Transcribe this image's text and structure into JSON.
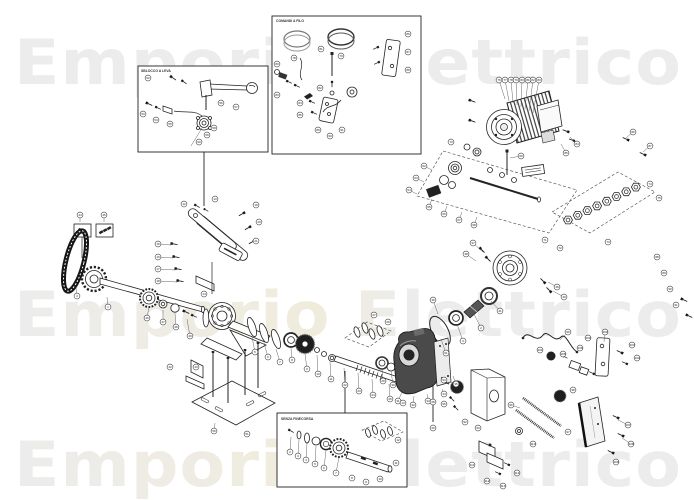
{
  "watermark": {
    "text": "Emporio Elettrico",
    "color": "#ececec",
    "tint": "#f2eeda"
  },
  "insets": {
    "release": {
      "label": "SBLOCCO A LEVA"
    },
    "controls": {
      "label": "COMANDI A FILO"
    },
    "no_limit": {
      "label": "SENZA FINECORSA"
    }
  },
  "diagram": {
    "balloons": [
      [
        52,
        148,
        78
      ],
      [
        53,
        143,
        114
      ],
      [
        54,
        156,
        120
      ],
      [
        55,
        170,
        124
      ],
      [
        56,
        221,
        103
      ],
      [
        57,
        236,
        107
      ],
      [
        58,
        214,
        128
      ],
      [
        59,
        207,
        135
      ],
      [
        60,
        199,
        142
      ],
      [
        78,
        294,
        58
      ],
      [
        79,
        341,
        56
      ],
      [
        80,
        277,
        64
      ],
      [
        81,
        321,
        49
      ],
      [
        82,
        320,
        88
      ],
      [
        83,
        277,
        95
      ],
      [
        84,
        300,
        103
      ],
      [
        85,
        300,
        115
      ],
      [
        86,
        408,
        34
      ],
      [
        87,
        408,
        52
      ],
      [
        88,
        408,
        70
      ],
      [
        89,
        318,
        130
      ],
      [
        90,
        330,
        136
      ],
      [
        91,
        342,
        130
      ],
      [
        15,
        158,
        244,
        171,
        245
      ],
      [
        16,
        158,
        257,
        173,
        258
      ],
      [
        17,
        158,
        269,
        175,
        270
      ],
      [
        18,
        158,
        281,
        177,
        282
      ],
      [
        12,
        184,
        204
      ],
      [
        13,
        215,
        199
      ],
      [
        19,
        256,
        205
      ],
      [
        20,
        259,
        222
      ],
      [
        21,
        256,
        241
      ],
      [
        14,
        204,
        294
      ],
      [
        44,
        80,
        215,
        80,
        222
      ],
      [
        45,
        104,
        215,
        104,
        222
      ],
      [
        4,
        77,
        296,
        76,
        288
      ],
      [
        1,
        108,
        307,
        107,
        297
      ],
      [
        46,
        147,
        318,
        149,
        307
      ],
      [
        47,
        163,
        322,
        163,
        310
      ],
      [
        48,
        176,
        327,
        175,
        313
      ],
      [
        49,
        190,
        336,
        187,
        319
      ],
      [
        42,
        170,
        367
      ],
      [
        43,
        196,
        367
      ],
      [
        50,
        214,
        431,
        215,
        423
      ],
      [
        51,
        247,
        434
      ],
      [
        5,
        255,
        352,
        252,
        337
      ],
      [
        6,
        268,
        357,
        264,
        343
      ],
      [
        7,
        280,
        362,
        276,
        349
      ],
      [
        8,
        292,
        360,
        291,
        348
      ],
      [
        9,
        307,
        369,
        305,
        354
      ],
      [
        10,
        318,
        374,
        317,
        355
      ],
      [
        11,
        331,
        379,
        330,
        362
      ],
      [
        22,
        345,
        385,
        344,
        368
      ],
      [
        23,
        359,
        391,
        358,
        373
      ],
      [
        24,
        373,
        395,
        372,
        379
      ],
      [
        25,
        390,
        399,
        389,
        384
      ],
      [
        26,
        433,
        428
      ],
      [
        27,
        374,
        315
      ],
      [
        28,
        388,
        322
      ],
      [
        29,
        383,
        381,
        382,
        369
      ],
      [
        30,
        393,
        385,
        391,
        371
      ],
      [
        31,
        398,
        401,
        402,
        392
      ],
      [
        32,
        413,
        405,
        414,
        396
      ],
      [
        33,
        428,
        401,
        427,
        394
      ],
      [
        34,
        444,
        394,
        442,
        389
      ],
      [
        35,
        456,
        384,
        453,
        376
      ],
      [
        36,
        433,
        300,
        438,
        314
      ],
      [
        37,
        473,
        243,
        483,
        252
      ],
      [
        38,
        466,
        254,
        476,
        261
      ],
      [
        39,
        557,
        287,
        548,
        282
      ],
      [
        40,
        564,
        297,
        553,
        291
      ],
      [
        41,
        500,
        311,
        491,
        301
      ],
      [
        2,
        481,
        328,
        473,
        312
      ],
      [
        3,
        463,
        341,
        457,
        324
      ],
      [
        61,
        446,
        353,
        441,
        339
      ],
      [
        62,
        424,
        166,
        432,
        170
      ],
      [
        63,
        416,
        178,
        424,
        182
      ],
      [
        64,
        409,
        190,
        417,
        194
      ],
      [
        65,
        429,
        207,
        432,
        199
      ],
      [
        66,
        444,
        214,
        447,
        206
      ],
      [
        67,
        459,
        220,
        462,
        212
      ],
      [
        68,
        474,
        225,
        477,
        217
      ],
      [
        69,
        521,
        156,
        510,
        158
      ],
      [
        70,
        451,
        142
      ],
      [
        71,
        545,
        240
      ],
      [
        72,
        560,
        248
      ],
      [
        73,
        608,
        242
      ],
      [
        74,
        650,
        184
      ],
      [
        75,
        659,
        198
      ],
      [
        76,
        499,
        80,
        505,
        99
      ],
      [
        77,
        505,
        80,
        509,
        101
      ],
      [
        78,
        511,
        80,
        513,
        103
      ],
      [
        79,
        516,
        80,
        517,
        105
      ],
      [
        80,
        522,
        80,
        521,
        107
      ],
      [
        81,
        528,
        80,
        525,
        109
      ],
      [
        82,
        533,
        80,
        529,
        111
      ],
      [
        83,
        539,
        80,
        533,
        113
      ],
      [
        84,
        577,
        144,
        570,
        137
      ],
      [
        85,
        566,
        153,
        561,
        144
      ],
      [
        86,
        633,
        132,
        626,
        138
      ],
      [
        87,
        650,
        146,
        643,
        152
      ],
      [
        88,
        657,
        257
      ],
      [
        89,
        664,
        273
      ],
      [
        90,
        670,
        289
      ],
      [
        91,
        676,
        305
      ],
      [
        92,
        465,
        422
      ],
      [
        93,
        478,
        428
      ],
      [
        94,
        444,
        380
      ],
      [
        95,
        444,
        404
      ],
      [
        96,
        511,
        405,
        520,
        408
      ],
      [
        97,
        568,
        432
      ],
      [
        98,
        573,
        390
      ],
      [
        99,
        568,
        332,
        560,
        340
      ],
      [
        100,
        588,
        338
      ],
      [
        101,
        540,
        350
      ],
      [
        102,
        605,
        332,
        604,
        342
      ],
      [
        103,
        632,
        345
      ],
      [
        104,
        637,
        358
      ],
      [
        105,
        563,
        354
      ],
      [
        106,
        580,
        348
      ],
      [
        107,
        628,
        425,
        618,
        420
      ],
      [
        108,
        631,
        444,
        622,
        438
      ],
      [
        109,
        616,
        462
      ],
      [
        110,
        533,
        444
      ],
      [
        111,
        472,
        465
      ],
      [
        112,
        487,
        481
      ],
      [
        113,
        503,
        486
      ],
      [
        114,
        517,
        473
      ],
      [
        2,
        290,
        452,
        291,
        437
      ],
      [
        3,
        298,
        456,
        299,
        440
      ],
      [
        4,
        306,
        460,
        307,
        443
      ],
      [
        5,
        315,
        464,
        316,
        446
      ],
      [
        6,
        324,
        468,
        326,
        450
      ],
      [
        7,
        336,
        473,
        339,
        457
      ],
      [
        8,
        352,
        478
      ],
      [
        9,
        366,
        482
      ],
      [
        10,
        380,
        479
      ],
      [
        11,
        396,
        463
      ],
      [
        12,
        398,
        440
      ],
      [
        13,
        403,
        403
      ],
      [
        28,
        433,
        402
      ]
    ]
  }
}
